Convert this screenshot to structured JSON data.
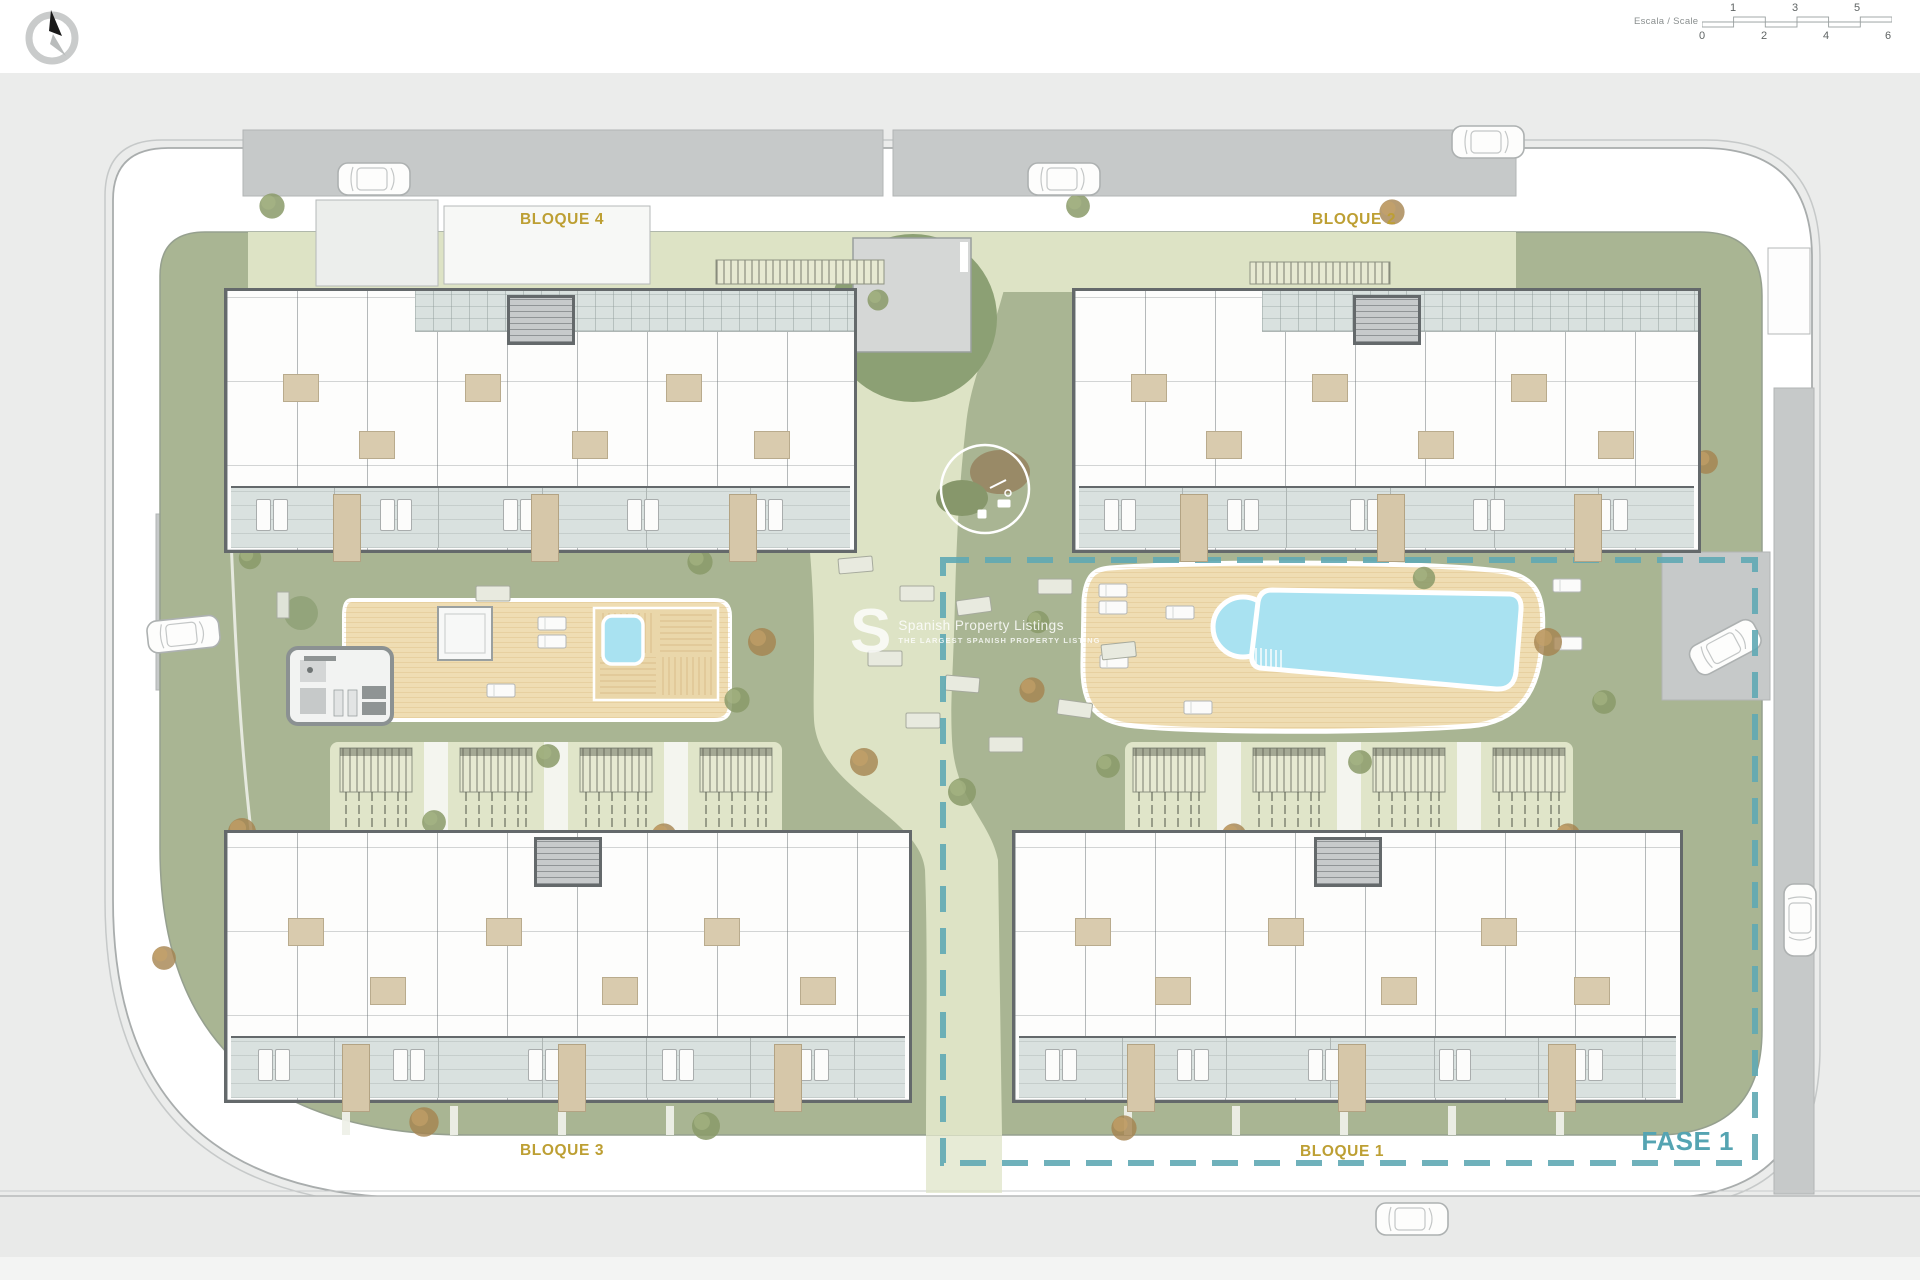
{
  "header": {
    "compass_name": "north-compass",
    "scale_bar": {
      "label": "Escala / Scale",
      "top_ticks": [
        "1",
        "3",
        "5"
      ],
      "bottom_ticks": [
        "0",
        "2",
        "4",
        "6"
      ]
    }
  },
  "plan": {
    "block_labels": {
      "b1": "BLOQUE 1",
      "b2": "BLOQUE 2",
      "b3": "BLOQUE 3",
      "b4": "BLOQUE 4"
    },
    "phase_label": "FASE 1"
  },
  "watermark": {
    "logo_letter": "S",
    "title": "Spanish Property Listings",
    "subtitle": "THE LARGEST SPANISH PROPERTY LISTING"
  },
  "colors": {
    "label_gold": "#bd9f33",
    "phase_teal": "#55a4b2",
    "lawn": "#a9b593",
    "path": "#dde3c5",
    "road": "#c6c9c9",
    "deck": "#efddb3",
    "pool": "#a9e2f1",
    "terrace_tile": "#d9e1df",
    "wall_gray": "#64696b",
    "canvas_bg": "#ebeceb"
  }
}
